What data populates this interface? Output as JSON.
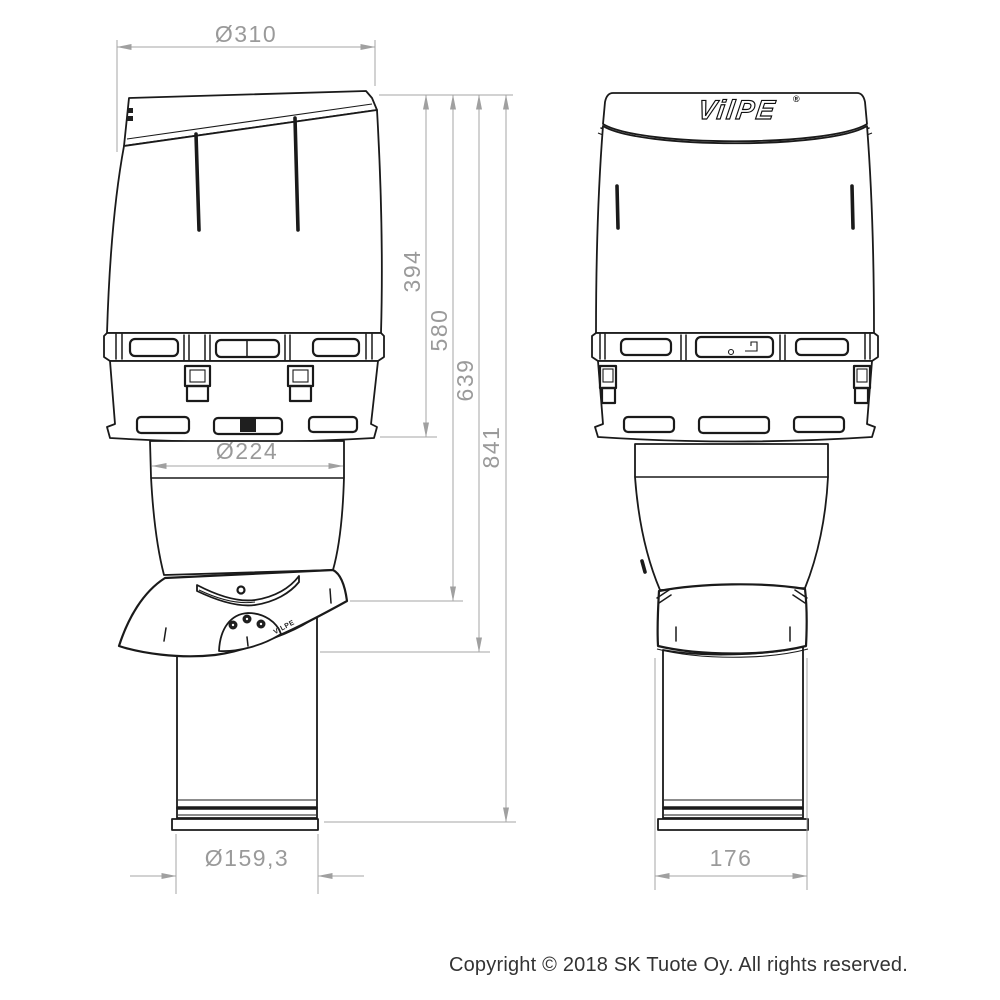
{
  "drawing": {
    "dim_top_diameter": "Ø310",
    "dim_cap_height": "394",
    "dim_height_to_seal_top": "580",
    "dim_height_to_seal_bottom": "639",
    "dim_total_height": "841",
    "dim_cap_bottom_diameter": "Ø224",
    "dim_pipe_diameter": "Ø159,3",
    "dim_base_width": "176"
  },
  "brand": {
    "logo_text": "VilPE",
    "registered_mark": "®",
    "embossed_text": "VILPE"
  },
  "footer": {
    "copyright": "Copyright © 2018 SK Tuote Oy. All rights reserved."
  },
  "colors": {
    "drawing_line": "#1a1a1a",
    "dimension_gray": "#9a9a9a",
    "footer_text": "#333333",
    "background": "#ffffff"
  }
}
